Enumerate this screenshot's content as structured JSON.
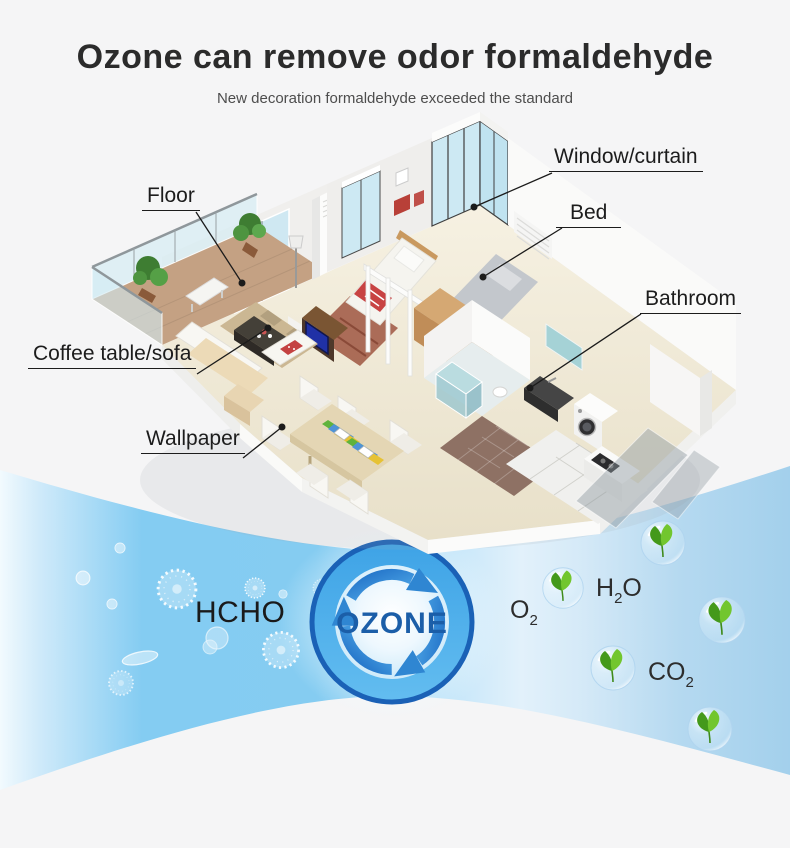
{
  "title": "Ozone can remove odor formaldehyde",
  "subtitle": "New decoration formaldehyde exceeded the standard",
  "apartment_labels": {
    "window_curtain": "Window/curtain",
    "bed": "Bed",
    "floor": "Floor",
    "bathroom": "Bathroom",
    "coffee_table_sofa": "Coffee table/sofa",
    "wallpaper": "Wallpaper"
  },
  "reaction": {
    "pollutant": "HCHO",
    "agent": "OZONE",
    "products": [
      {
        "formula_main": "O",
        "formula_sub": "2",
        "formula_tail": ""
      },
      {
        "formula_main": "H",
        "formula_sub": "2",
        "formula_tail": "O"
      },
      {
        "formula_main": "CO",
        "formula_sub": "2",
        "formula_tail": ""
      }
    ]
  },
  "colors": {
    "title_text": "#2b2b2b",
    "subtitle_text": "#4d4d4d",
    "label_text": "#1c1c1c",
    "band_blue": "#7fcbf2",
    "ozone_ring_fill": "#45a9e8",
    "ozone_ring_border": "#1a61b6",
    "ozone_text": "#1b5ea8",
    "leaf_green": "#5cb32a"
  }
}
